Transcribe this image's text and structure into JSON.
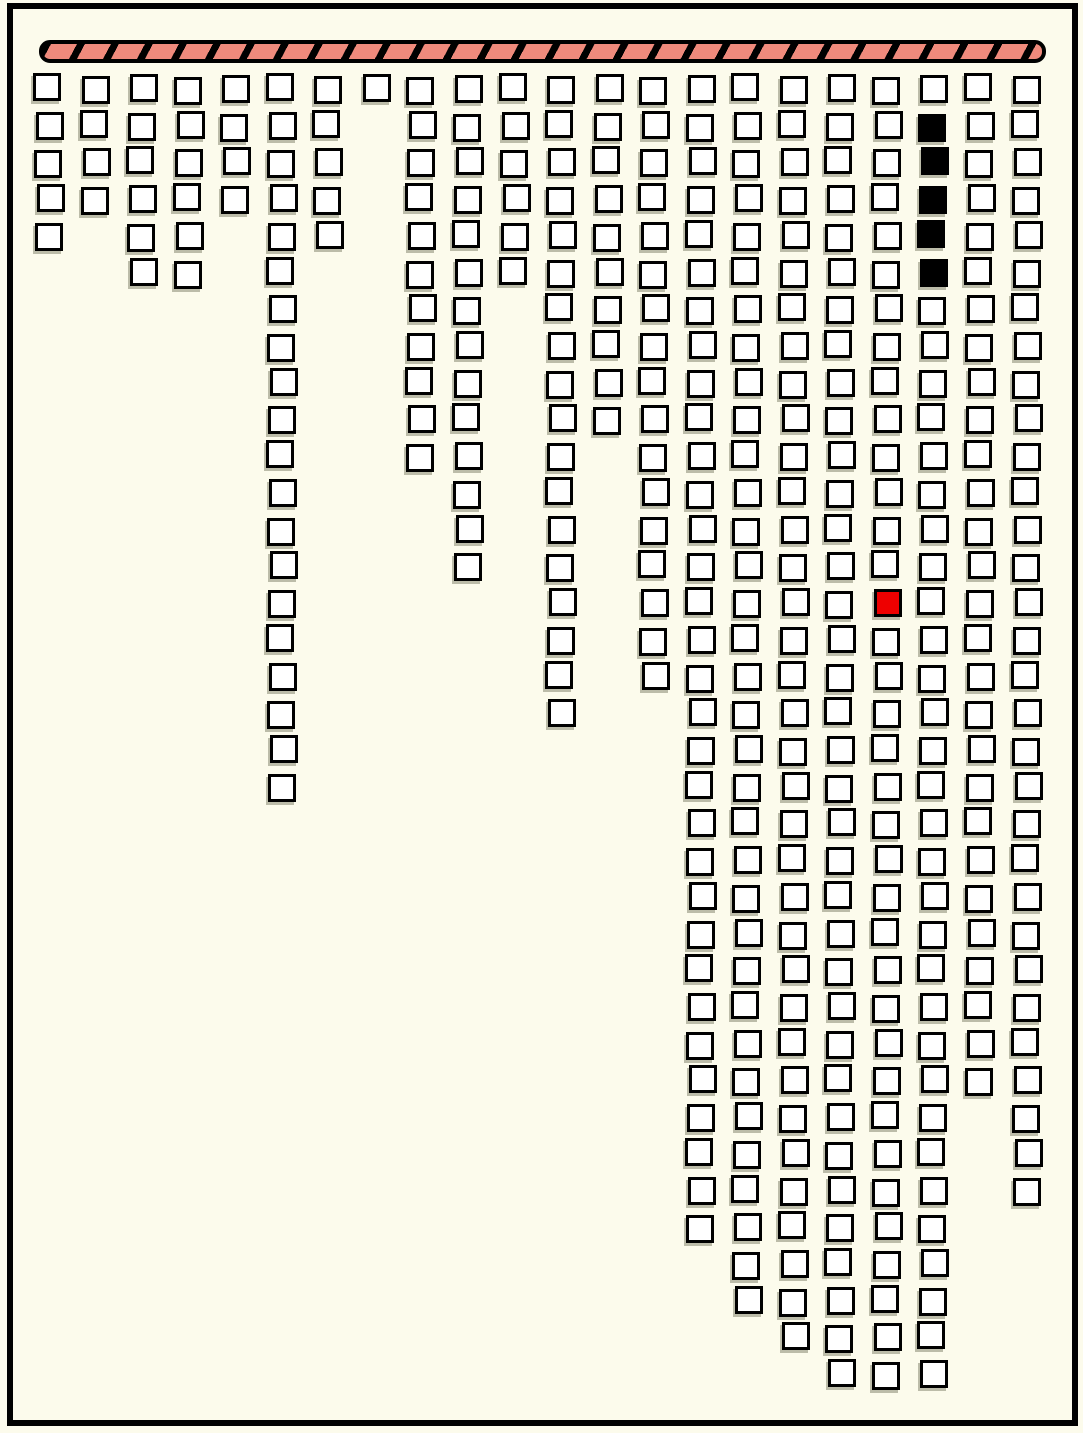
{
  "scene": {
    "canvas": {
      "width": 1083,
      "height": 1433,
      "background": "#FCFBEC",
      "frame": {
        "left": 7,
        "top": 3,
        "width": 1071,
        "height": 1423,
        "thickness": 6
      }
    },
    "palette": {
      "ink": "#000000",
      "cell_fill": "#FFFFFF",
      "cell_shadow": "rgba(110,110,88,0.45)",
      "red": "#EE0000",
      "black": "#000000",
      "bar_fill": "#EF8A7C"
    },
    "ceiling_bar": {
      "left": 39,
      "top": 40,
      "width": 1007,
      "height": 23,
      "border_px": 4,
      "corner_radius": 11,
      "stripe_angle_deg": 118,
      "stripe_black_px": 7,
      "stripe_period_px": 30
    },
    "grid": {
      "columns": 22,
      "max_rows": 36,
      "origin_x": 35,
      "origin_y": 75,
      "col_spacing": 46.55,
      "row_spacing": 36.72,
      "cell_size": 28,
      "cell_border_px": 3
    },
    "chain_lengths": [
      5,
      4,
      6,
      6,
      4,
      20,
      5,
      1,
      11,
      14,
      6,
      18,
      10,
      17,
      32,
      34,
      35,
      36,
      36,
      36,
      28,
      31
    ],
    "special_cells": [
      {
        "col": 19,
        "row": 15,
        "color": "red",
        "name": "red-cell"
      },
      {
        "col": 20,
        "row": 2,
        "color": "black",
        "name": "black-cell"
      },
      {
        "col": 20,
        "row": 3,
        "color": "black",
        "name": "black-cell"
      },
      {
        "col": 20,
        "row": 4,
        "color": "black",
        "name": "black-cell"
      },
      {
        "col": 20,
        "row": 5,
        "color": "black",
        "name": "black-cell"
      },
      {
        "col": 20,
        "row": 6,
        "color": "black",
        "name": "black-cell"
      }
    ]
  }
}
